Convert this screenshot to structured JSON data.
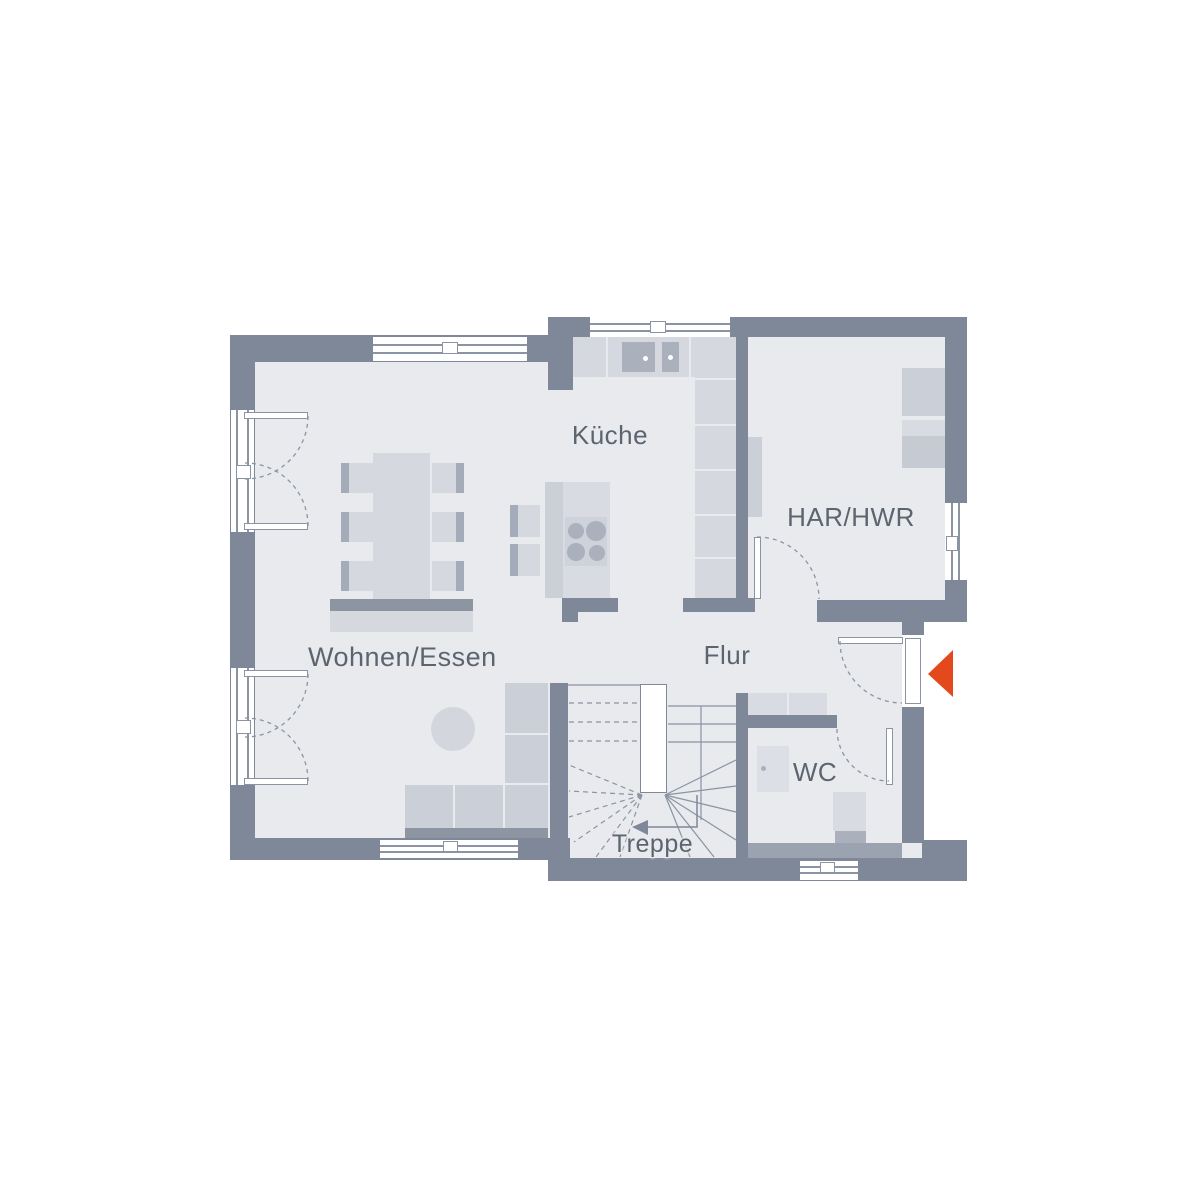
{
  "canvas": {
    "type": "architectural-floor-plan",
    "background": "#ffffff"
  },
  "rooms": {
    "kueche": "Küche",
    "har_hwr": "HAR/HWR",
    "wohnen_essen": "Wohnen/Essen",
    "flur": "Flur",
    "wc": "WC",
    "treppe": "Treppe"
  },
  "icons": {
    "entrance_arrow": "left-pointing-entrance-triangle",
    "stair_direction_arrow": "left-pointing-stair-direction-arrow"
  },
  "colors": {
    "wall": "#7e8898",
    "floor": "#e8eaee",
    "furniture_light": "#d5d8df",
    "furniture_mid": "#cbd0d8",
    "furniture_dark": "#8d95a3",
    "fixture_gray": "#aab1bd",
    "outline_gray": "#8a94a3",
    "label_text": "#5c656f",
    "accent_entrance": "#e3491c"
  }
}
